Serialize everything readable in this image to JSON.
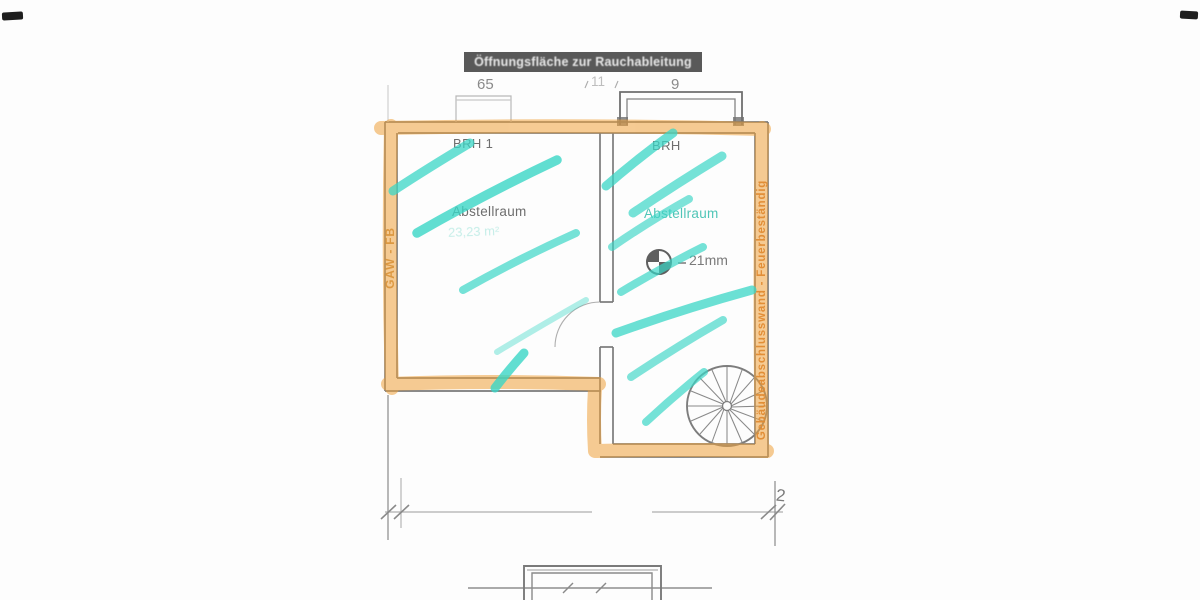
{
  "colors": {
    "paper": "#fdfdfd",
    "ink_gray": "#6f6f6f",
    "header_bg": "#595959",
    "highlight_orange": "#f0a23c",
    "marker_teal": "#3ad6c6",
    "label_gray": "#6e6e6e",
    "teal_text": "#3ec0b0",
    "orange_text_left": "#c08136",
    "orange_text_right": "#cf6f26"
  },
  "header": {
    "title": "Öffnungsfläche zur Rauchableitung"
  },
  "dimensions": {
    "top_left": "65",
    "top_mid": "11",
    "top_right": "9",
    "bottom_right": "2"
  },
  "rooms": {
    "left": {
      "window_label": "BRH 1",
      "name": "Abstellraum",
      "area_note": "23,23 m²"
    },
    "right": {
      "window_label": "BRH",
      "name": "Abstellraum",
      "material_note": "21mm"
    }
  },
  "annotations": {
    "left_wall_vertical": "GAW - FB",
    "right_wall_vertical": "Gebäudeabschlusswand - Feuerbeständig"
  },
  "icons": {
    "quadrant_symbol": "center-point-icon",
    "spiral_stair": "spiral-staircase-icon"
  }
}
